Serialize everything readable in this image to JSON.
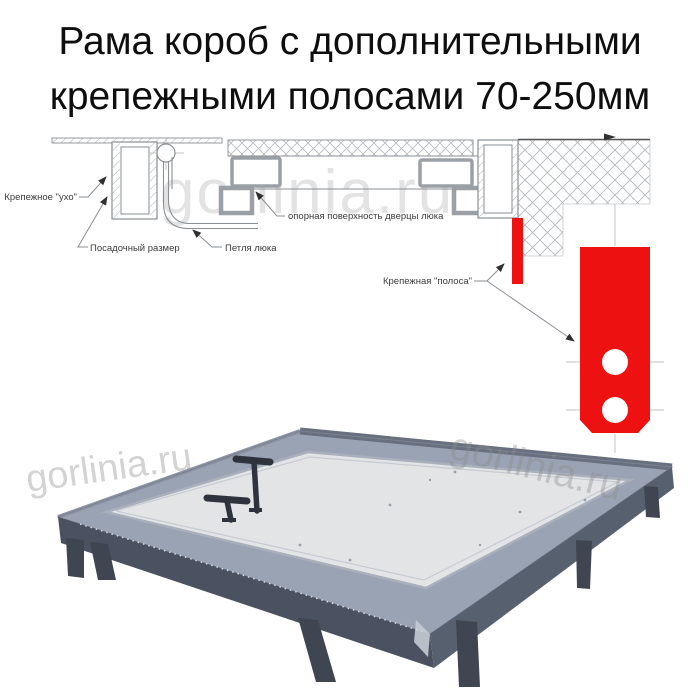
{
  "title": {
    "line1": "Рама короб с дополнительными",
    "line2": "крепежными полосами 70-250мм"
  },
  "watermark": {
    "text": "gorlinia.ru"
  },
  "diagram": {
    "labels": {
      "ear": "Крепежное \"ухо\"",
      "mount_size": "Посадочный размер",
      "hinge": "Петля люка",
      "support_surface": "опорная поверхность дверцы люка",
      "strip": "Крепежная \"полоса\""
    },
    "colors": {
      "strip_red": "#ee1111",
      "line_gray": "#8a8f94",
      "label_text": "#3b3b3b",
      "watermark_gray": "#cccccc"
    }
  },
  "photo": {
    "colors": {
      "frame_dark": "#4a5160",
      "frame_mid": "#57606f",
      "rim_light": "#9aa3b4",
      "rim_edge_dark": "#687080",
      "panel_light": "#e3e4e6",
      "handle_dark": "#2e333d",
      "leg_dark": "#3f4652"
    }
  }
}
